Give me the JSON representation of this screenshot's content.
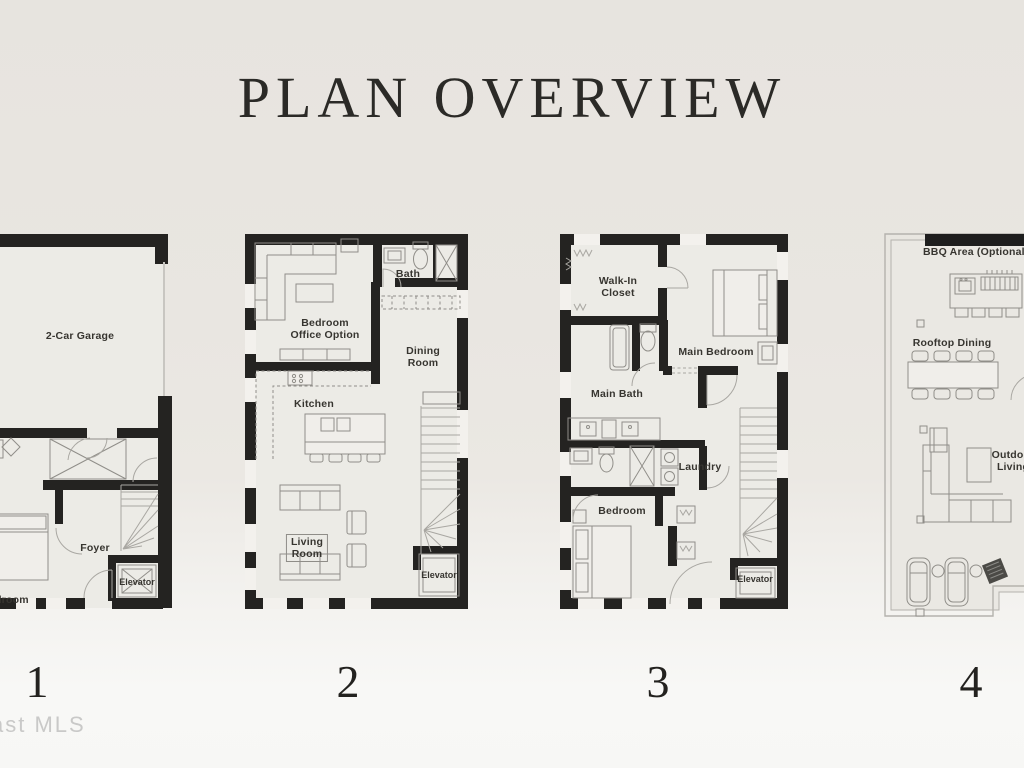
{
  "header": {
    "title": "PLAN OVERVIEW"
  },
  "watermark": "ast MLS",
  "colors": {
    "background_top": "#e7e4df",
    "background_bottom": "#f8f8f6",
    "wall": "#242321",
    "label_text": "#373530",
    "title_text": "#2b2a27",
    "furniture_line": "#908e89"
  },
  "plans": [
    {
      "number": "1",
      "labels": {
        "garage": "2-Car Garage",
        "foyer": "Foyer",
        "bedroom": "Bedroom",
        "elevator": "Elevator"
      }
    },
    {
      "number": "2",
      "labels": {
        "bedroom_office": [
          "Bedroom",
          "Office Option"
        ],
        "bath": "Bath",
        "dining": [
          "Dining",
          "Room"
        ],
        "kitchen": "Kitchen",
        "living": [
          "Living",
          "Room"
        ],
        "elevator": "Elevator"
      }
    },
    {
      "number": "3",
      "labels": {
        "walk_in": [
          "Walk-In",
          "Closet"
        ],
        "main_bedroom": "Main Bedroom",
        "main_bath": "Main Bath",
        "laundry": "Laundry",
        "bedroom": "Bedroom",
        "elevator": "Elevator"
      }
    },
    {
      "number": "4",
      "labels": {
        "bbq_area": "BBQ Area (Optional P",
        "rooftop_dining": "Rooftop Dining",
        "outdoor_living": [
          "Outdoor",
          "Living"
        ]
      }
    }
  ]
}
